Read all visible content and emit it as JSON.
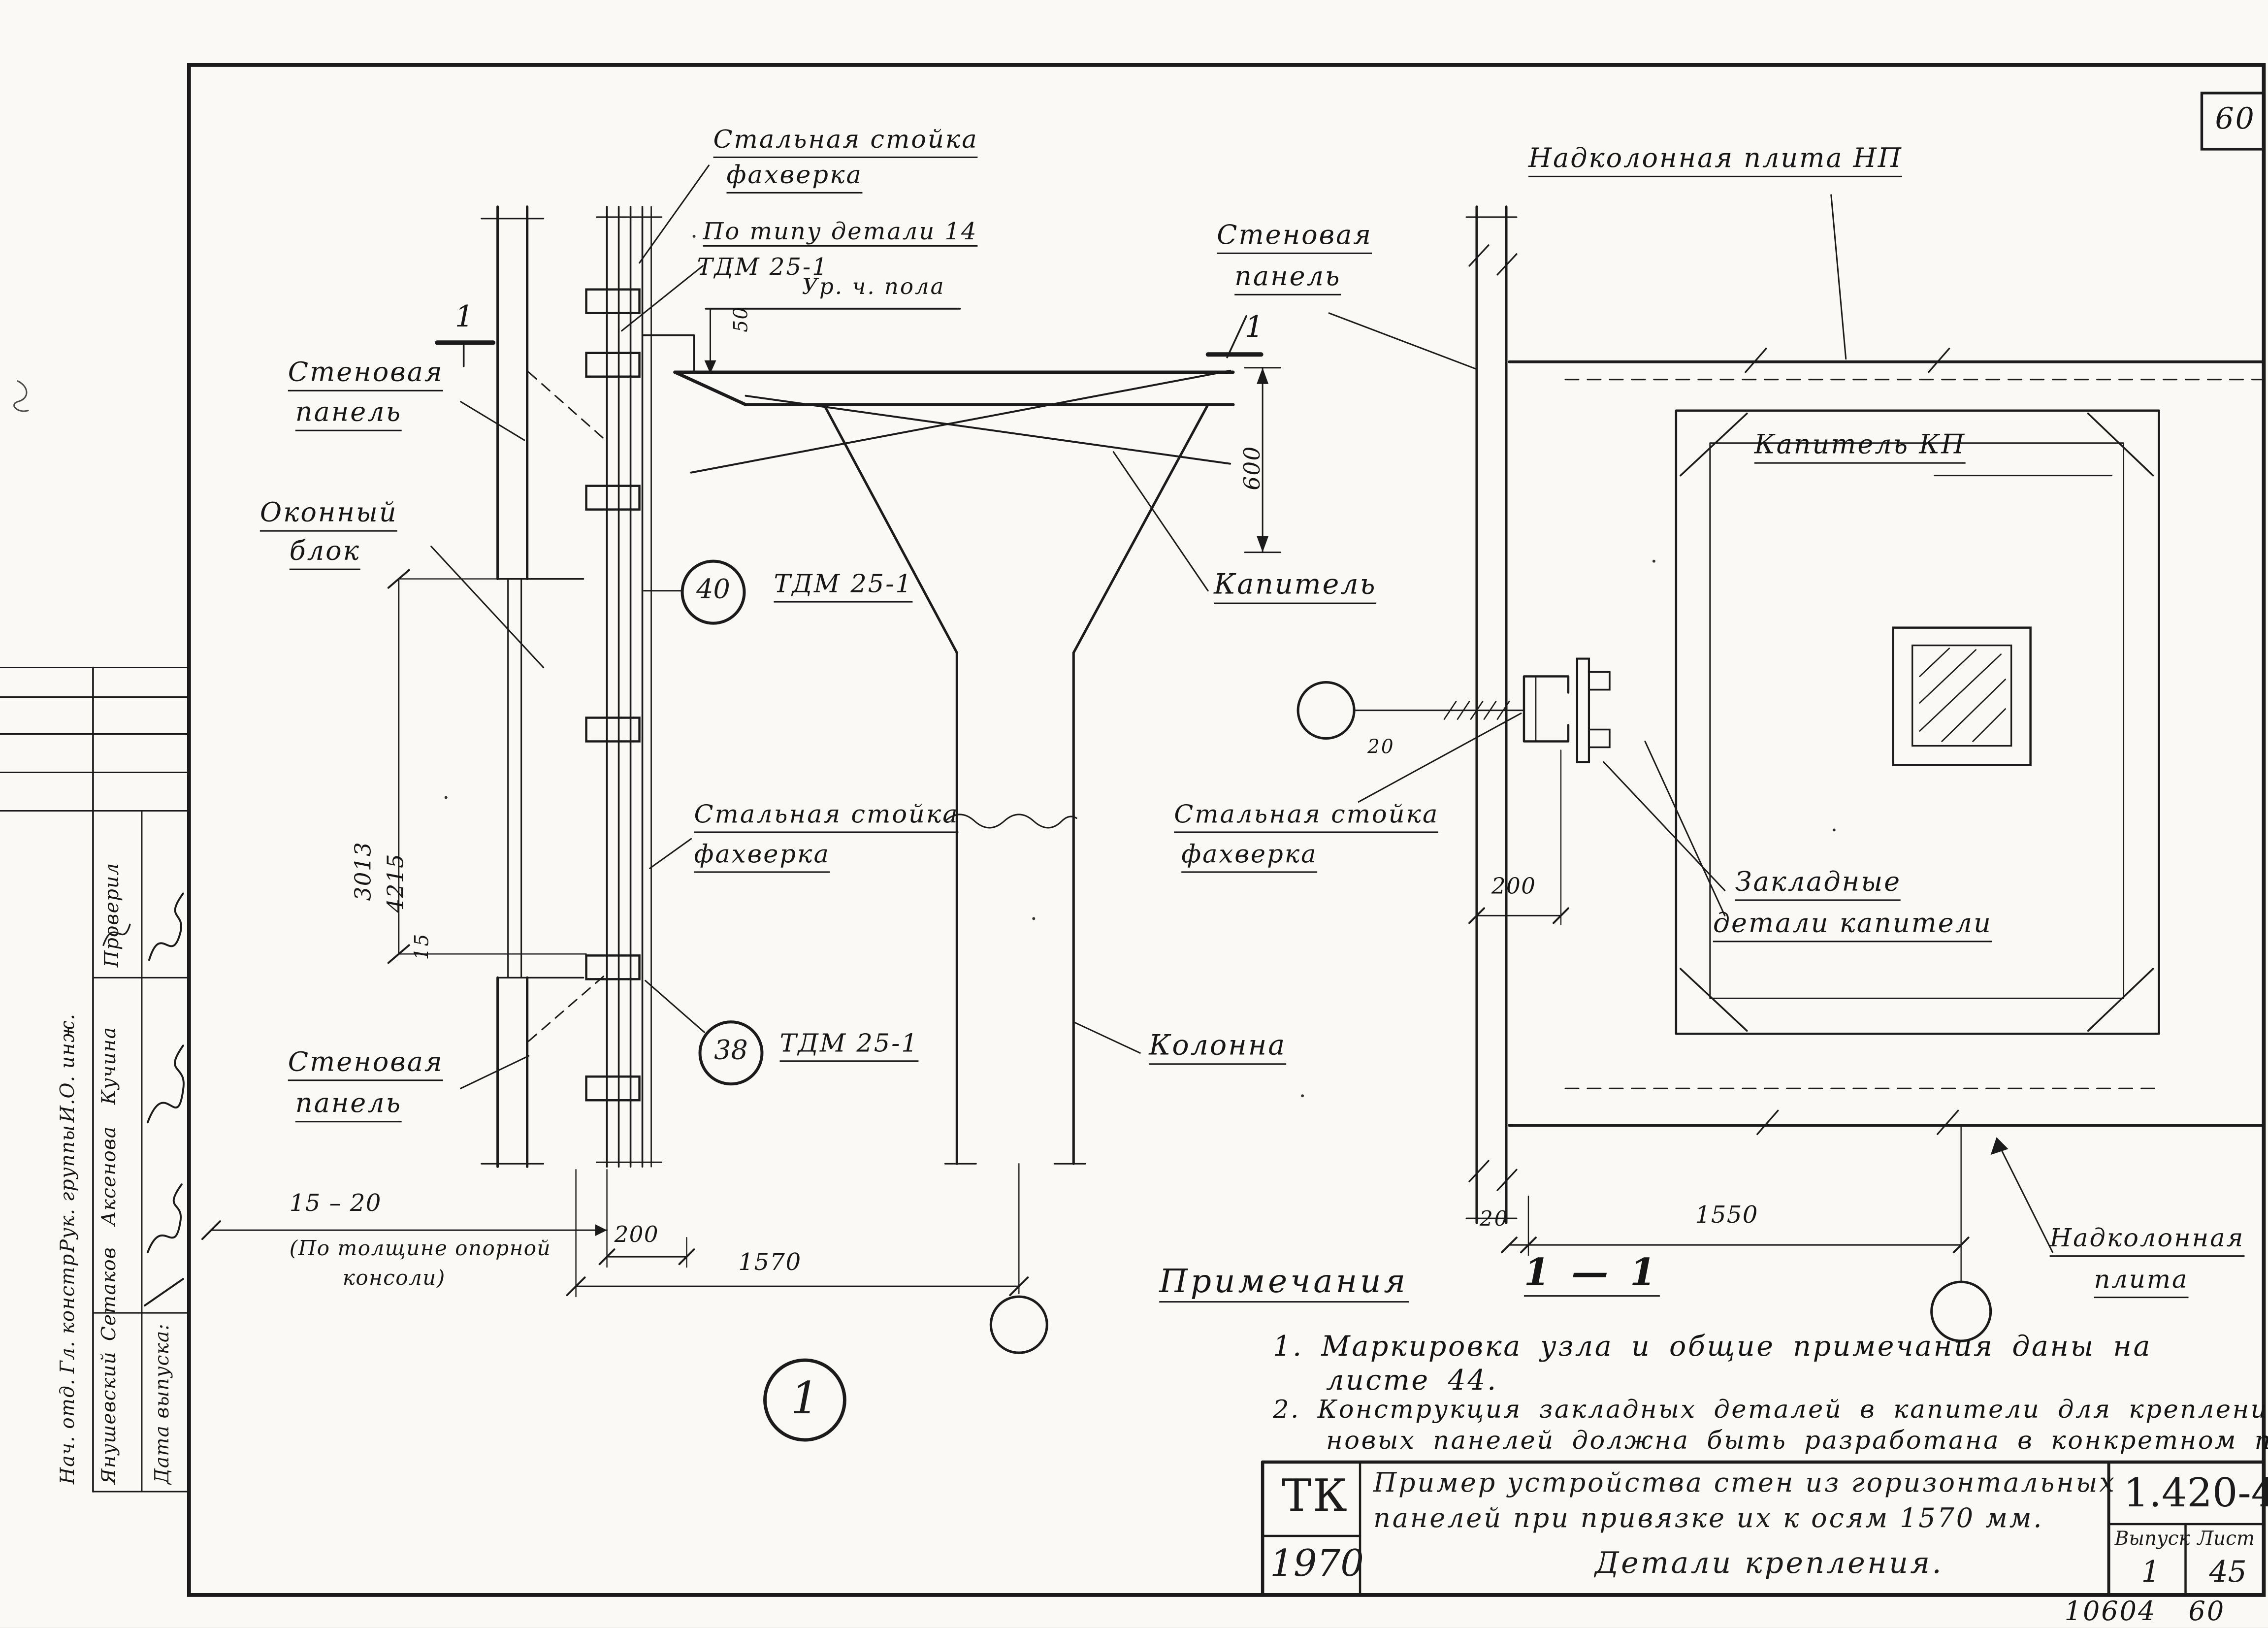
{
  "sheet": {
    "corner_number": "60",
    "footer_code": "10604",
    "footer_sheet": "60"
  },
  "left_view": {
    "labels": {
      "steel_post_top_1": "Стальная стойка",
      "steel_post_top_2": "фахверка",
      "detail_type_1": "По типу детали 14",
      "detail_type_2": "ТДМ 25-1",
      "floor_level": "Ур. ч. пола",
      "wall_panel_top_1": "Стеновая",
      "wall_panel_top_2": "панель",
      "window_block_1": "Оконный",
      "window_block_2": "блок",
      "balloon_40": "40",
      "balloon_40_label": "ТДМ 25-1",
      "steel_post_mid_1": "Стальная стойка",
      "steel_post_mid_2": "фахверка",
      "wall_panel_bottom_1": "Стеновая",
      "wall_panel_bottom_2": "панель",
      "balloon_38": "38",
      "balloon_38_label": "ТДМ 25-1",
      "capital": "Капитель",
      "column": "Колонна",
      "section_mark_left": "1",
      "section_mark_right": "1",
      "node_number": "1"
    },
    "dims": {
      "d50": "50",
      "d600": "600",
      "d3013": "3013",
      "d4215": "4215",
      "d15": "15",
      "d15_20": "15 – 20",
      "d15_20_note_1": "(По толщине опорной",
      "d15_20_note_2": "консоли)",
      "d200": "200",
      "d1570": "1570"
    }
  },
  "right_view": {
    "labels": {
      "plate_top": "Надколонная плита НП",
      "wall_panel_1": "Стеновая",
      "wall_panel_2": "панель",
      "capital_kp": "Капитель КП",
      "steel_post_1": "Стальная стойка",
      "steel_post_2": "фахверка",
      "embedded_1": "Закладные",
      "embedded_2": "детали капители",
      "plate_bottom_1": "Надколонная",
      "plate_bottom_2": "плита",
      "section_title": "1 — 1"
    },
    "dims": {
      "d20_detail": "20",
      "d200": "200",
      "d20": "20",
      "d1550": "1550"
    }
  },
  "notes": {
    "header": "Примечания",
    "n1_1": "1. Маркировка узла и общие примечания даны на",
    "n1_2": "листе 44.",
    "n2_1": "2. Конструкция закладных деталей в капители для крепления сте-",
    "n2_2": "новых панелей должна быть разработана в конкретном проекте"
  },
  "title_block": {
    "org": "ТК",
    "year": "1970",
    "title_1": "Пример устройства стен из горизонтальных",
    "title_2": "панелей при привязке их к осям 1570 мм.",
    "title_3": "Детали крепления.",
    "code": "1.420-4",
    "issue_label": "Выпуск",
    "issue_value": "1",
    "sheet_label": "Лист",
    "sheet_value": "45"
  },
  "signature_block": {
    "checked_label": "Проверил",
    "date_label": "Дата выпуска:",
    "rows": [
      {
        "role": "Нач. отд.",
        "name": "Янушевский"
      },
      {
        "role": "Гл. констр.",
        "name": "Сетаков"
      },
      {
        "role": "Рук. группы",
        "name": "Аксенова"
      },
      {
        "role": "И.О. инж.",
        "name": "Кучина"
      }
    ]
  }
}
